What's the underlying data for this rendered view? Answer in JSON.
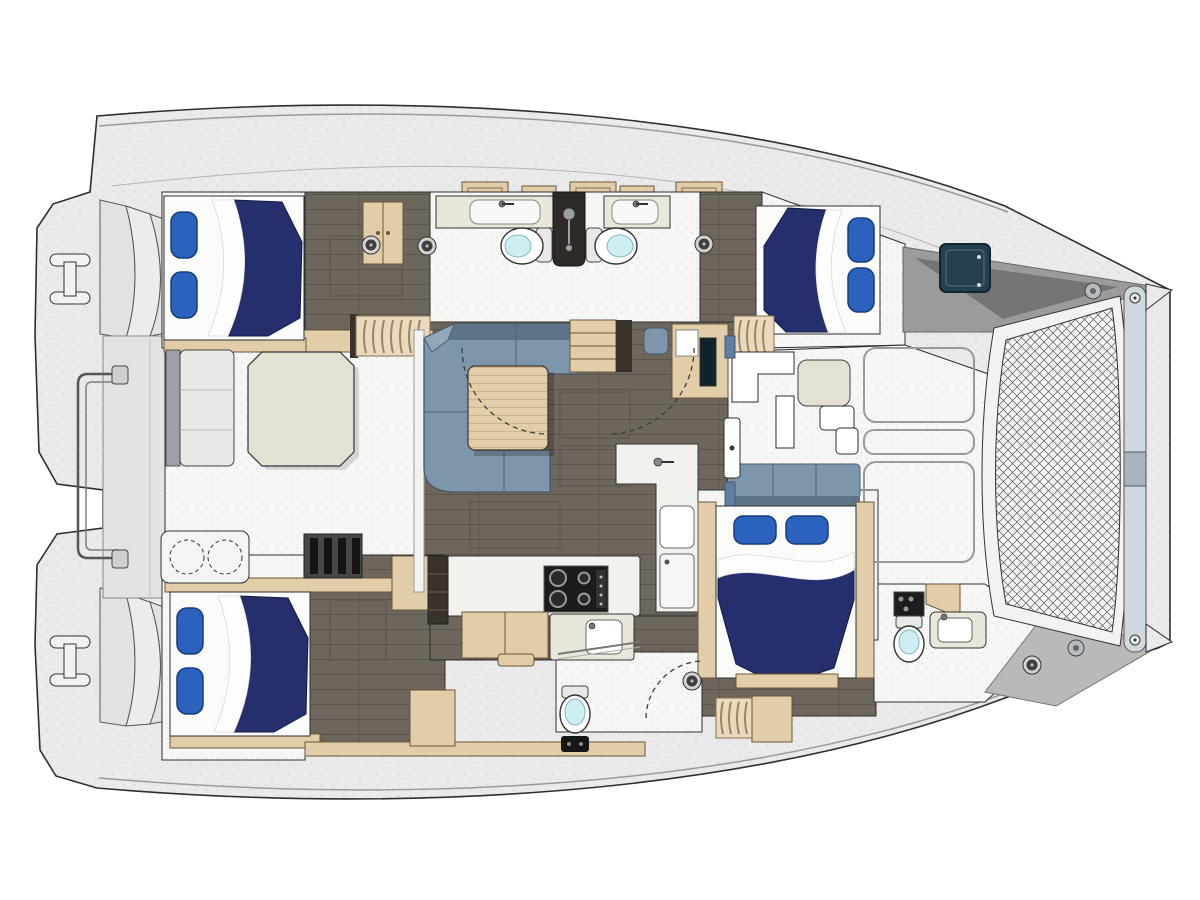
{
  "palette": {
    "outline": "#2e2e2e",
    "deck": "#eaeaea",
    "deck_dot": "#dadada",
    "room": "#f6f6f5",
    "room_dot": "#dddddd",
    "floor": "#6d665c",
    "floor_line": "#5b544b",
    "wood": "#e2cda9",
    "wood_dark": "#6b5639",
    "wood_grain": "#cdb48c",
    "navy": "#262f6d",
    "navy_edge": "#141a45",
    "pillow": "#2b62bd",
    "pillow_edge": "#163c7e",
    "sofa": "#7e96ab",
    "sofa_dark": "#5d7488",
    "sofa_light": "#93a7b8",
    "table_beige": "#e4e0d2",
    "counter": "#f1f1ee",
    "counter_beige": "#e9e6da",
    "toilet_lid": "#cdeef2",
    "divider_dark": "#2f2a25",
    "hatch_teal": "#25414f",
    "bench_gray": "#e8e8e6",
    "bench_back": "#9aa0a6",
    "stove": "#1c1c1c",
    "tramp_bg": "#f4f4f2",
    "tramp_line": "#585858",
    "beam": "#cfd8de",
    "gray_deck": "#9b9b9b",
    "gray_wedge": "#747474",
    "slat_bg": "#474747",
    "slat": "#141414",
    "stair_dark": "#3a332c",
    "white": "#ffffff"
  },
  "inventory": {
    "hulls": 2,
    "stern_swim_platforms": 2,
    "stern_step_flights": 2,
    "mooring_cleats": 2,
    "double_berths": 4,
    "bed_pillows": 8,
    "toilets": 4,
    "sink_basins": 5,
    "shower_column": 1,
    "stove_burners": 4,
    "grill_burners": 2,
    "salon_sofa": 1,
    "coffee_table": 1,
    "cockpit_octagon_table": 1,
    "forward_cockpit_table": 1,
    "nav_station": 1,
    "companionway_stairs": 4,
    "deck_hatches": 5,
    "roof_hatches": 5,
    "door_swings": 3,
    "trampoline": 1,
    "forward_crossbeam": 1,
    "stern_rail": 1
  },
  "orientation": {
    "bow": "right",
    "stern": "left"
  }
}
